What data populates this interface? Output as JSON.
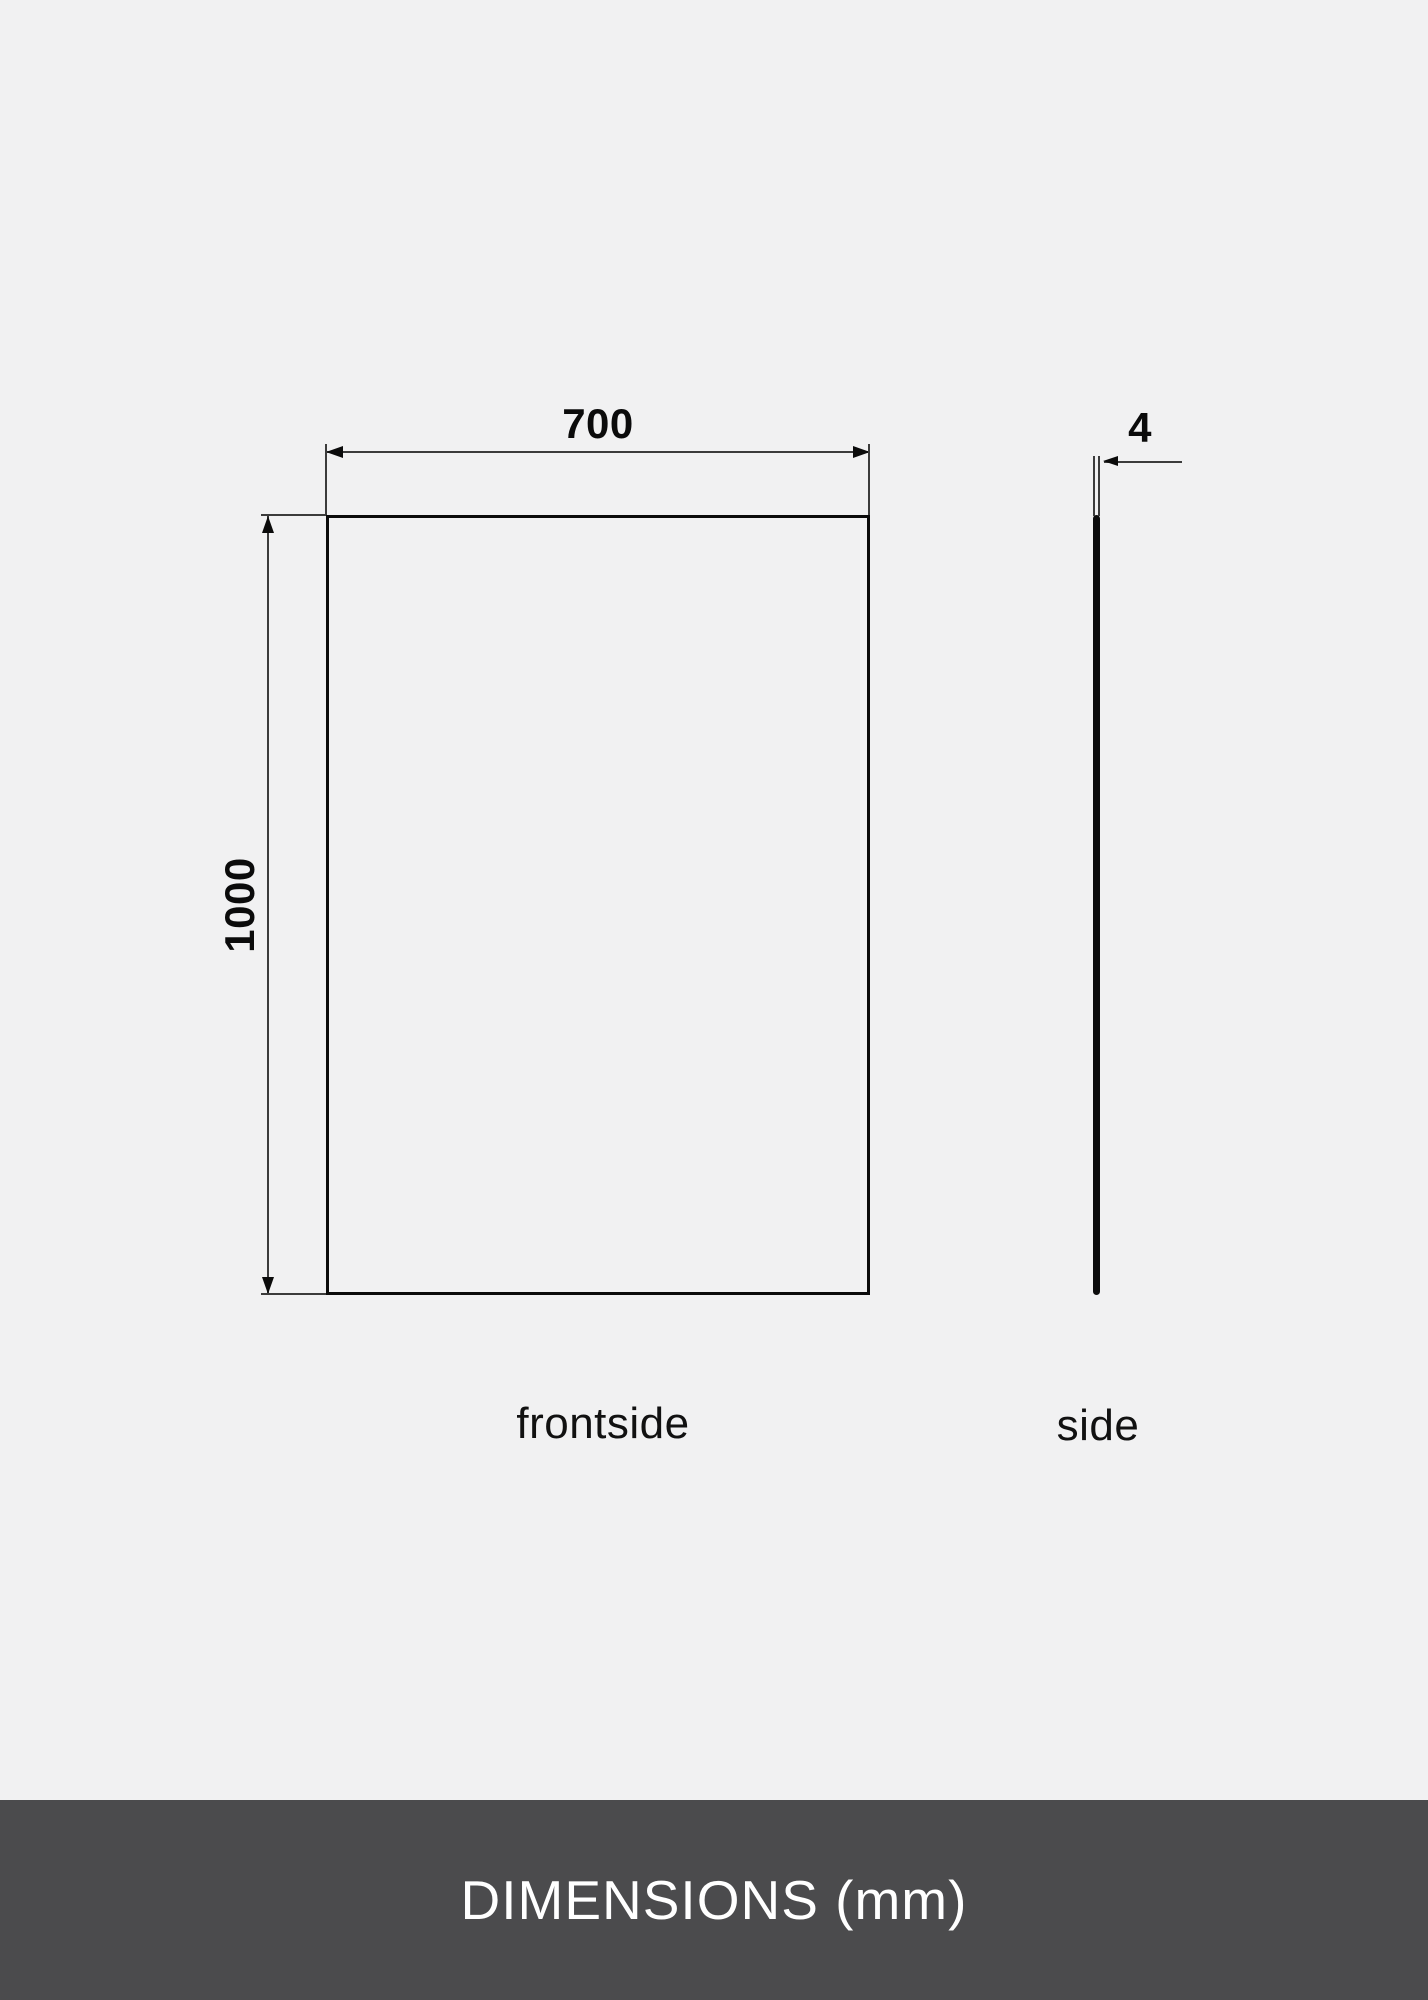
{
  "diagram": {
    "front_view": {
      "width_label": "700",
      "height_label": "1000",
      "caption": "frontside"
    },
    "side_view": {
      "thickness_label": "4",
      "caption": "side"
    },
    "footer_title": "DIMENSIONS (mm)",
    "colors": {
      "background": "#F1F1F2",
      "footer_background": "#4B4B4D",
      "line": "#0B0B0B",
      "thin_line": "#3C3C3C",
      "footer_text": "#FFFFFF"
    }
  }
}
